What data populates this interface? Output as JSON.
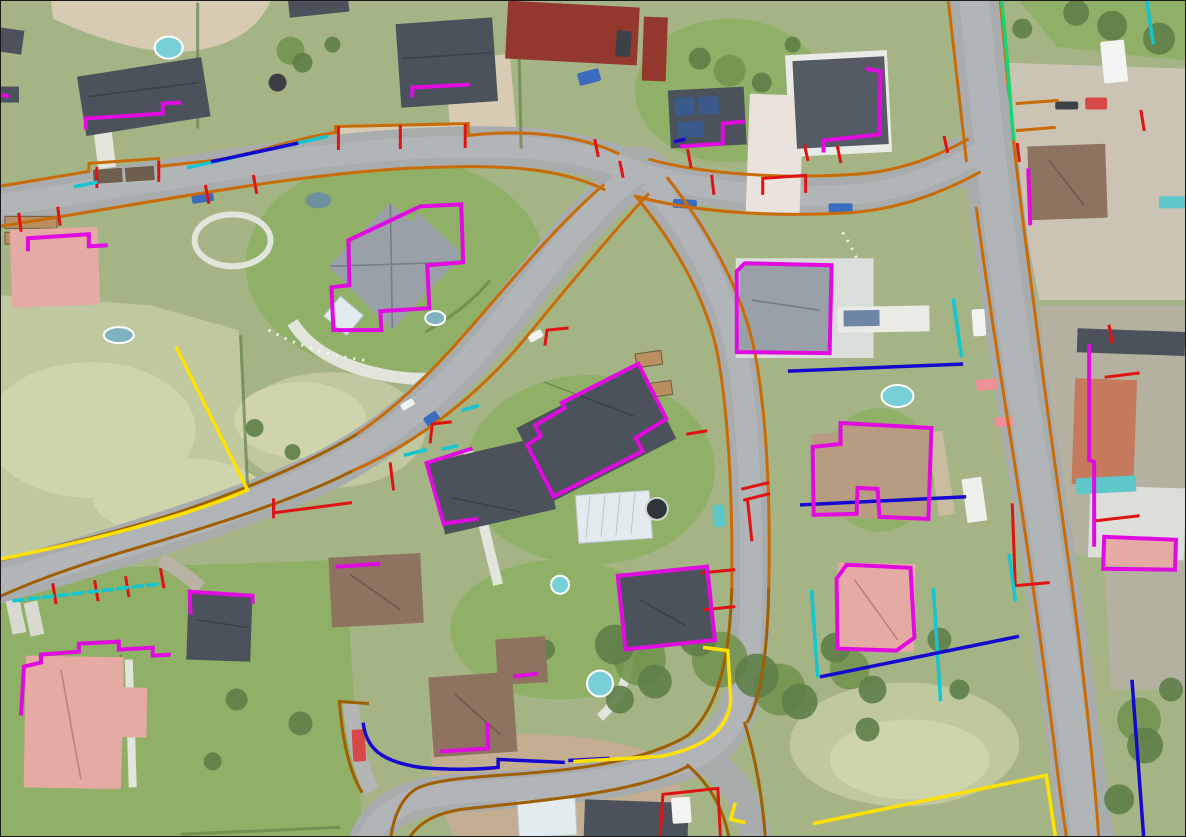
{
  "meta": {
    "scene": "aerial-orthophoto-residential-neighborhood-with-cadastral-vector-overlay",
    "width_px": 1186,
    "height_px": 837
  },
  "palette": {
    "canvas_border": "#1a1a1a",
    "lawn": "#a5b485",
    "lawn_bright": "#8fb066",
    "meadow": "#bfc89e",
    "meadow_pale": "#d0d4ac",
    "road": "#a8acad",
    "road_light": "#babec0",
    "sand": "#d8cbb4",
    "gravel": "#cbc4b4",
    "dirt": "#c3ae92",
    "yard": "#b5b1a0",
    "tree": "#5f7f49",
    "tree_light": "#74934f",
    "hedge": "#6d8a50",
    "path_white": "#e2e5dc",
    "roof_dark": "#4b525b",
    "roof_gray": "#99a0a8",
    "roof_red": "#94382d",
    "roof_salmon": "#e5aaa3",
    "roof_brown": "#8f7361",
    "roof_tan": "#b89c82",
    "roof_tile": "#c57a5e",
    "structure_white": "#e9ebe7",
    "glass": "#e4ebee",
    "solar": "#3a5a8c",
    "bed_soil": "#b98f62",
    "pool_cyan": "#79cfd6",
    "pond": "#7fb3c0",
    "pool_dark": "#2f343a",
    "car_blue": "#3c6cc0",
    "car_dark": "#3c4248",
    "car_white": "#f2f4f2",
    "car_red": "#d84848",
    "car_pink": "#ef8f98",
    "container_teal": "#5ec7c9"
  },
  "overlay": {
    "colors": {
      "building_outline": "#e10ae1",
      "road_edge": "#c96c08",
      "road_edge_dark": "#a05f00",
      "parcel_red": "#e01212",
      "parcel_blue": "#1408d0",
      "parcel_cyan": "#12c6d2",
      "parcel_yellow": "#ffe203",
      "parcel_green": "#16d673"
    },
    "layers": [
      {
        "id": "building-outlines",
        "label": "Building outlines (magenta)"
      },
      {
        "id": "road-edges",
        "label": "Road edges (orange)"
      },
      {
        "id": "road-edges-dark",
        "label": "Road edges (dark orange)"
      },
      {
        "id": "parcel-red",
        "label": "Parcel boundary marks (red)"
      },
      {
        "id": "parcel-blue",
        "label": "Parcel boundaries (blue)"
      },
      {
        "id": "parcel-cyan",
        "label": "Parcel boundaries (cyan)"
      },
      {
        "id": "parcel-yellow",
        "label": "Parcel boundaries (yellow)"
      },
      {
        "id": "parcel-green",
        "label": "Parcel boundary (green)"
      }
    ]
  }
}
